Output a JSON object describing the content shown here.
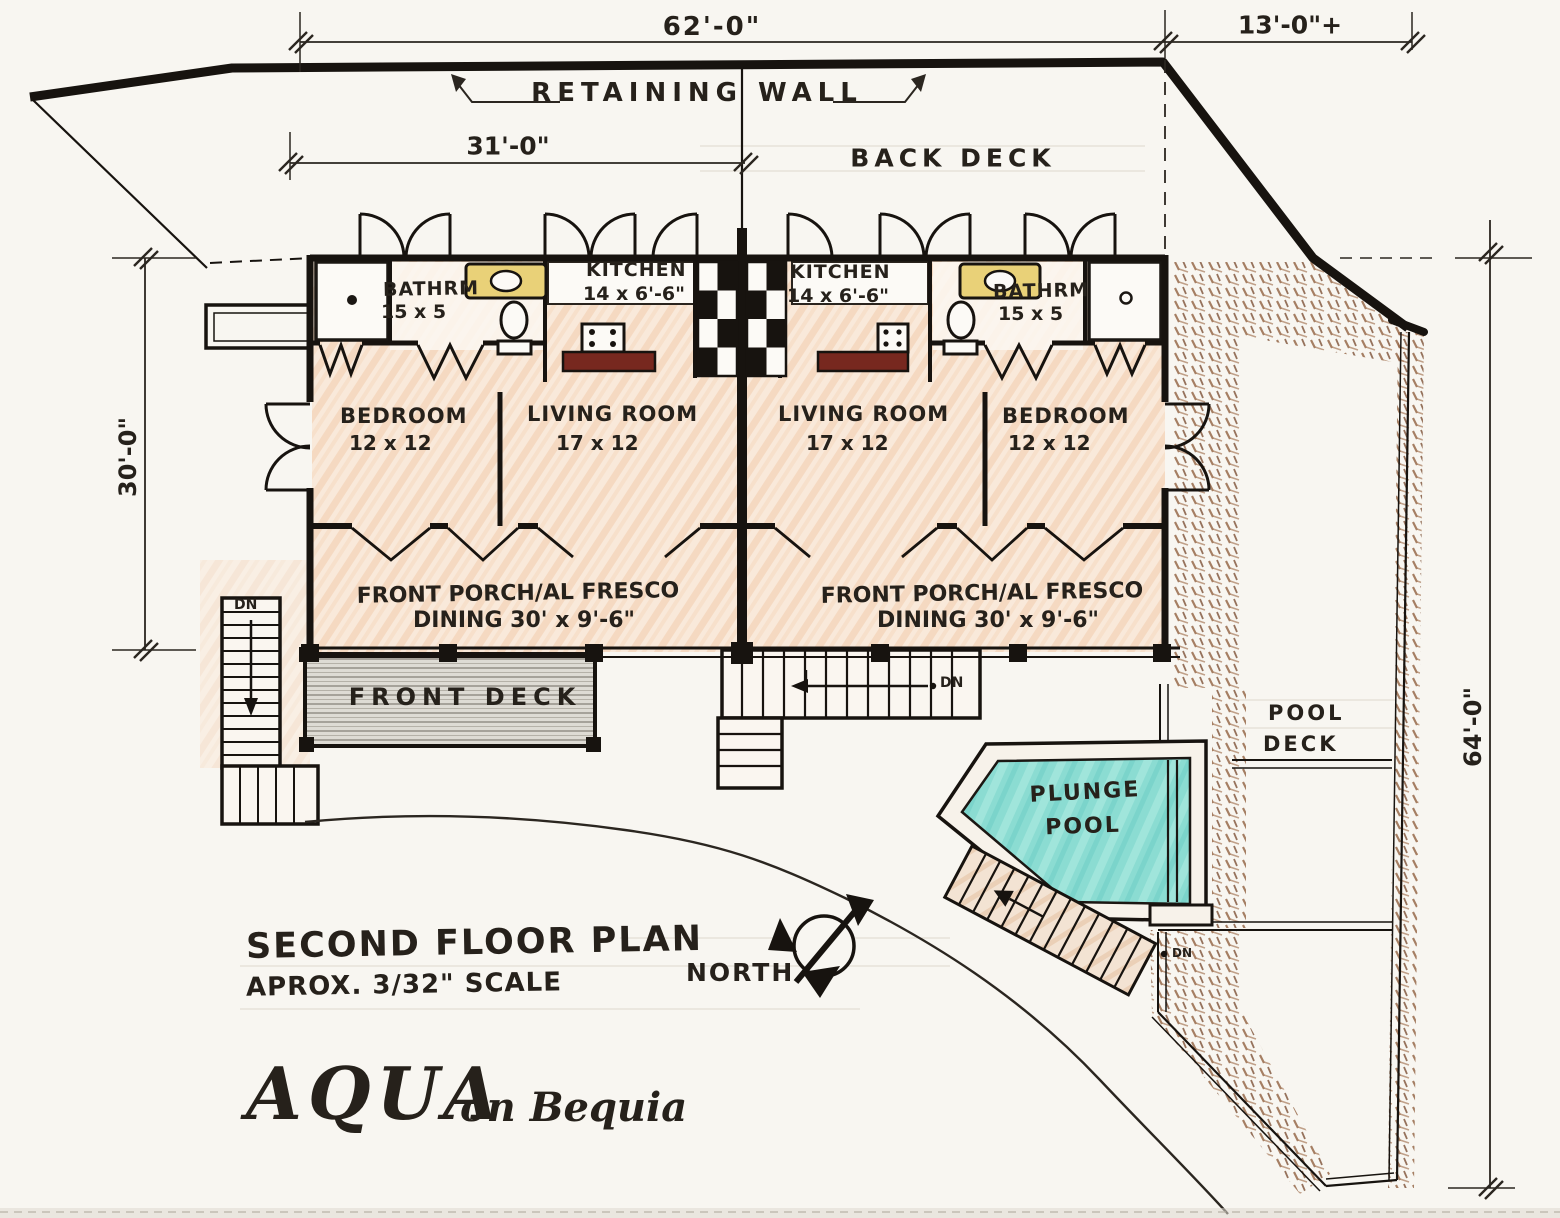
{
  "page": {
    "title": "SECOND FLOOR PLAN",
    "scale_note": "APROX. 3/32\" SCALE",
    "north_label": "NORTH"
  },
  "logo": {
    "name": "AQUA",
    "tagline": "on Bequia"
  },
  "dimensions": {
    "top_overall": "62'-0\"",
    "top_right": "13'-0\"+",
    "upper_partial": "31'-0\"",
    "left_side": "30'-0\"",
    "right_side": "64'-0\""
  },
  "site": {
    "retaining_wall": "RETAINING WALL",
    "back_deck": "BACK DECK",
    "front_deck": "FRONT DECK",
    "pool_deck_line1": "POOL",
    "pool_deck_line2": "DECK",
    "plunge_pool_line1": "PLUNGE",
    "plunge_pool_line2": "POOL"
  },
  "units": {
    "left": {
      "bathroom_label": "BATHRM",
      "bathroom_size": "15 x 5",
      "kitchen_label": "KITCHEN",
      "kitchen_size": "14 x 6'-6\"",
      "bedroom_label": "BEDROOM",
      "bedroom_size": "12 x 12",
      "living_label": "LIVING ROOM",
      "living_size": "17 x 12",
      "porch_line1": "FRONT PORCH/AL FRESCO",
      "porch_line2": "DINING  30' x 9'-6\""
    },
    "right": {
      "bathroom_label": "BATHRM",
      "bathroom_size": "15 x 5",
      "kitchen_label": "KITCHEN",
      "kitchen_size": "14 x 6'-6\"",
      "bedroom_label": "BEDROOM",
      "bedroom_size": "12 x 12",
      "living_label": "LIVING ROOM",
      "living_size": "17 x 12",
      "porch_line1": "FRONT PORCH/AL FRESCO",
      "porch_line2": "DINING  30' x 9'-6\""
    }
  },
  "stairs": {
    "left_dn": "DN",
    "middle_dn": "DN",
    "pool_dn": "DN"
  },
  "colors": {
    "ink": "#241f1a",
    "room_fill": "#f6ddc5",
    "pool_water": "#8bdcd2",
    "sink_counter": "#e9d178",
    "stove_counter": "#77281f",
    "path_brown": "#96684a",
    "deck_gray": "#dedbd4",
    "paper": "#f8f6f1"
  }
}
